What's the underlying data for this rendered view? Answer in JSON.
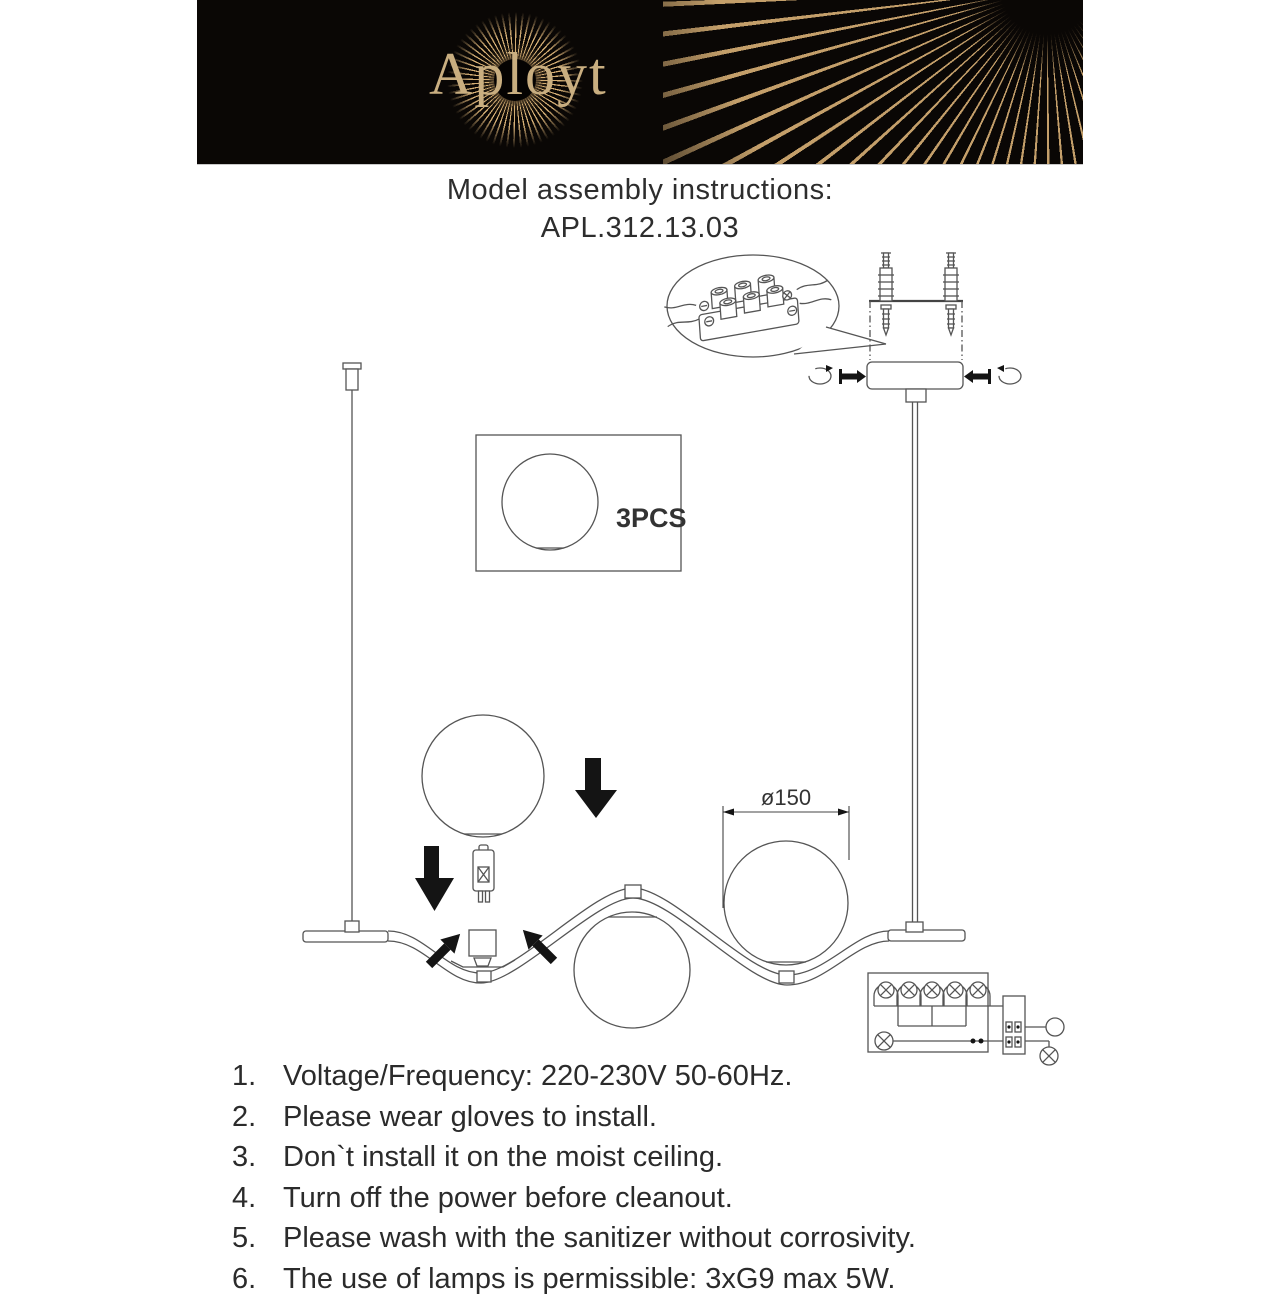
{
  "header": {
    "brand": "Aployt"
  },
  "title": {
    "line1": "Model assembly instructions:",
    "line2": "APL.312.13.03"
  },
  "diagram": {
    "parts_box_label": "3PCS",
    "dimension_label": "ø150"
  },
  "instructions": {
    "items": [
      {
        "num": "1.",
        "text": "Voltage/Frequency: 220-230V 50-60Hz."
      },
      {
        "num": "2.",
        "text": "Please wear gloves to install."
      },
      {
        "num": "3.",
        "text": "Don`t install it on the moist ceiling."
      },
      {
        "num": "4.",
        "text": "Turn off the power before cleanout."
      },
      {
        "num": "5.",
        "text": "Please wash with the sanitizer without corrosivity."
      },
      {
        "num": "6.",
        "text": "The use of lamps is permissible: 3xG9 max 5W."
      }
    ]
  },
  "colors": {
    "banner_bg": "#0a0705",
    "brand_gold": "#c9ae80",
    "ray_gold": "#dcb47c",
    "line_art": "#555555",
    "text": "#2b2b2b"
  }
}
